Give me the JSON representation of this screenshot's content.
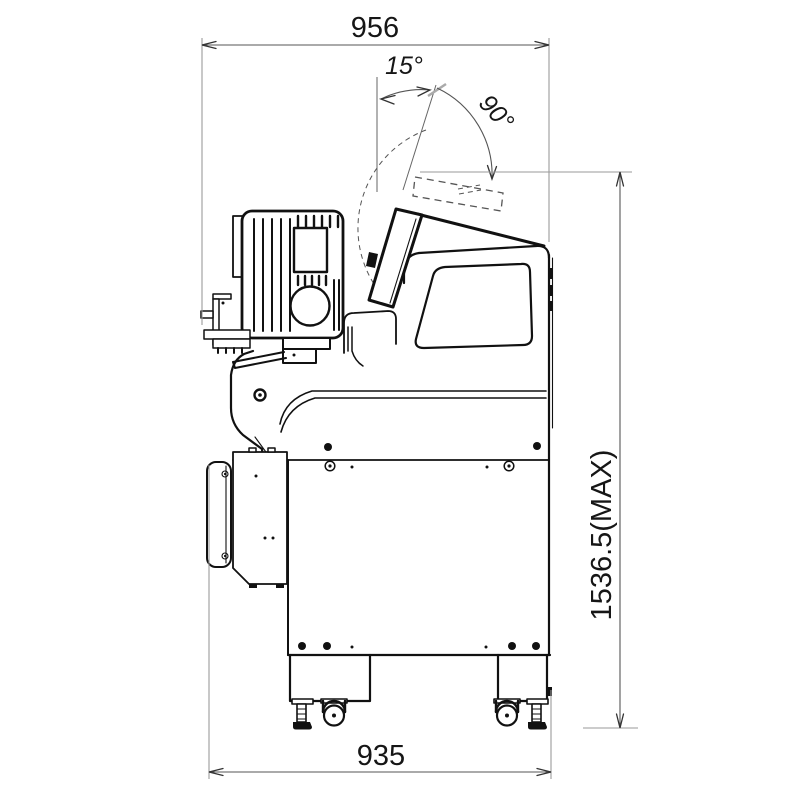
{
  "drawing": {
    "type": "technical-side-view-dimension-drawing",
    "background_color": "#ffffff",
    "line_color": "#111111",
    "dimension_line_color": "#555555",
    "extension_line_color": "#9a9a9a"
  },
  "dimensions": {
    "top_width": {
      "label": "956"
    },
    "bottom_width": {
      "label": "935"
    },
    "max_height": {
      "label": "1536.5(MAX)"
    },
    "tilt_angle": {
      "label": "15°"
    },
    "swing_angle": {
      "label": "90°"
    }
  }
}
